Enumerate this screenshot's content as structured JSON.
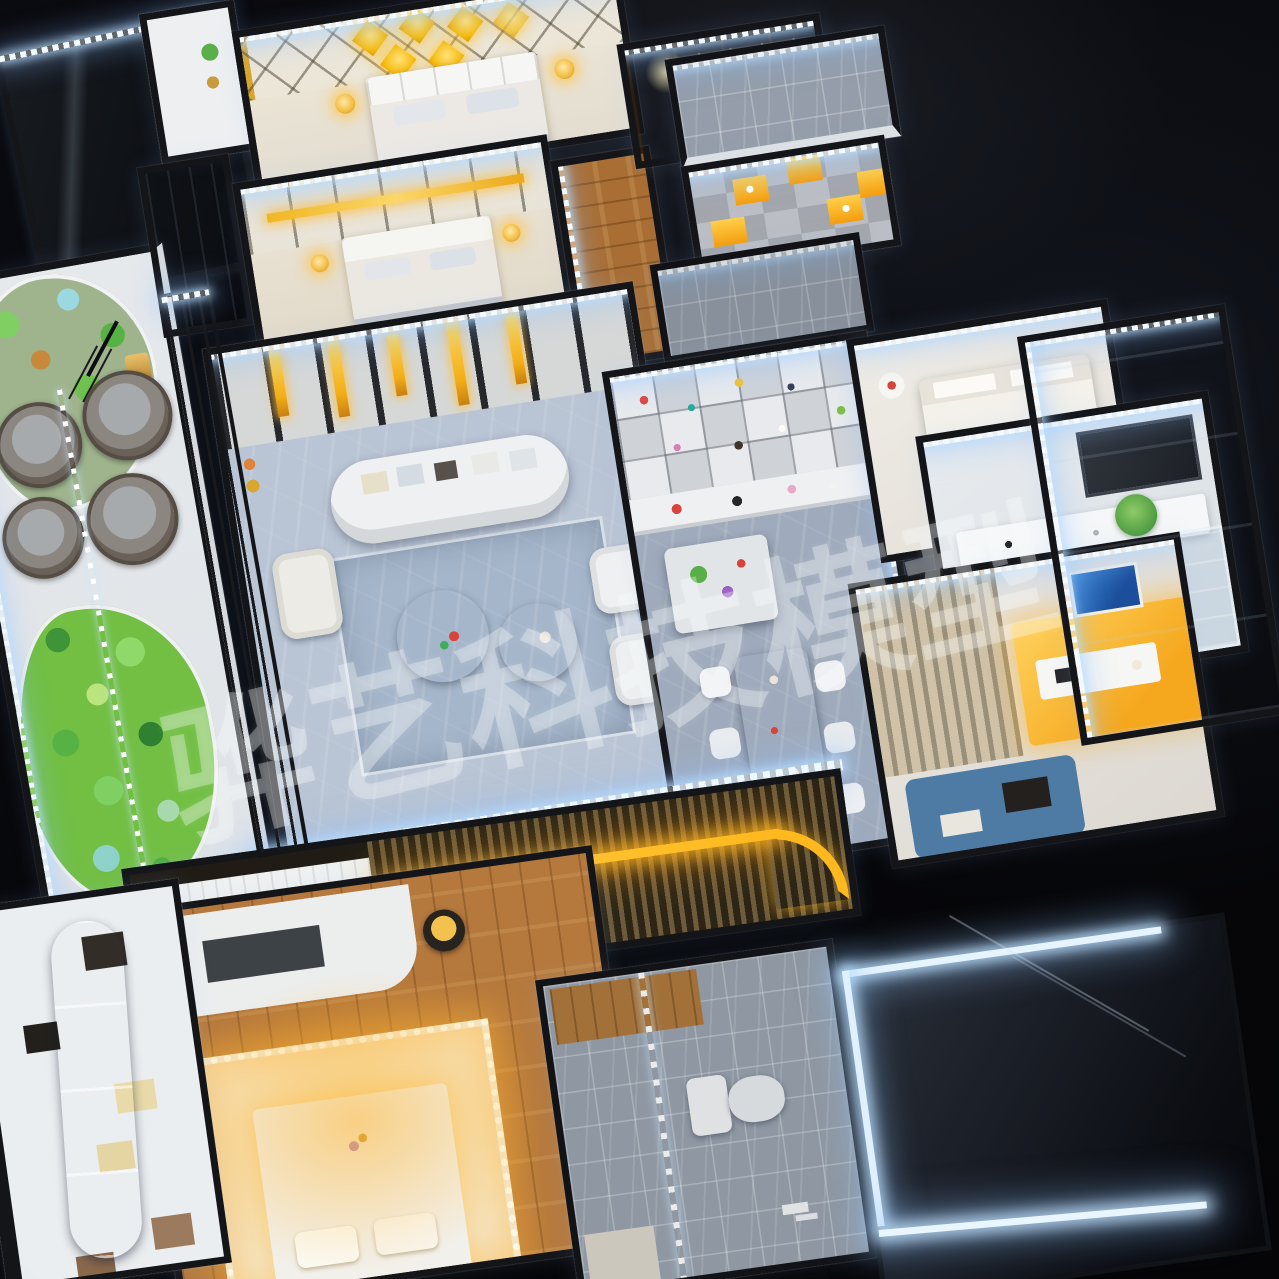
{
  "image": {
    "kind": "night photograph of an LED-illuminated miniature apartment scale model, dollhouse cutaway viewed from above at an oblique angle",
    "background": "#060709"
  },
  "watermark": {
    "text": "骅艺科技模型",
    "color": "#ffffff",
    "opacity": 0.32
  },
  "palette": {
    "led_cool": "#eaf7ff",
    "led_warm": "#ffb81e",
    "gold": "#f0b429",
    "marble_gray": "#a9b4c2",
    "wood": "#b0753a",
    "plant_green": "#4fae3f",
    "wall_white": "#eef0f2",
    "frame_black": "#141519",
    "sofa_blue": "#4e86ad",
    "night_sky": "#060709"
  },
  "scene": {
    "rooms": [
      "garden-balcony",
      "primary-bedroom",
      "walk-in-closet",
      "top-bathroom",
      "display-pantry",
      "mid-bathroom",
      "second-bedroom",
      "living-room",
      "kitchen-dining",
      "master-bedroom",
      "vanity-bathroom",
      "study-bedroom",
      "glass-balcony",
      "lower-bedroom",
      "lower-bathroom",
      "blue-sofa-lounge",
      "glass-skylight"
    ]
  }
}
